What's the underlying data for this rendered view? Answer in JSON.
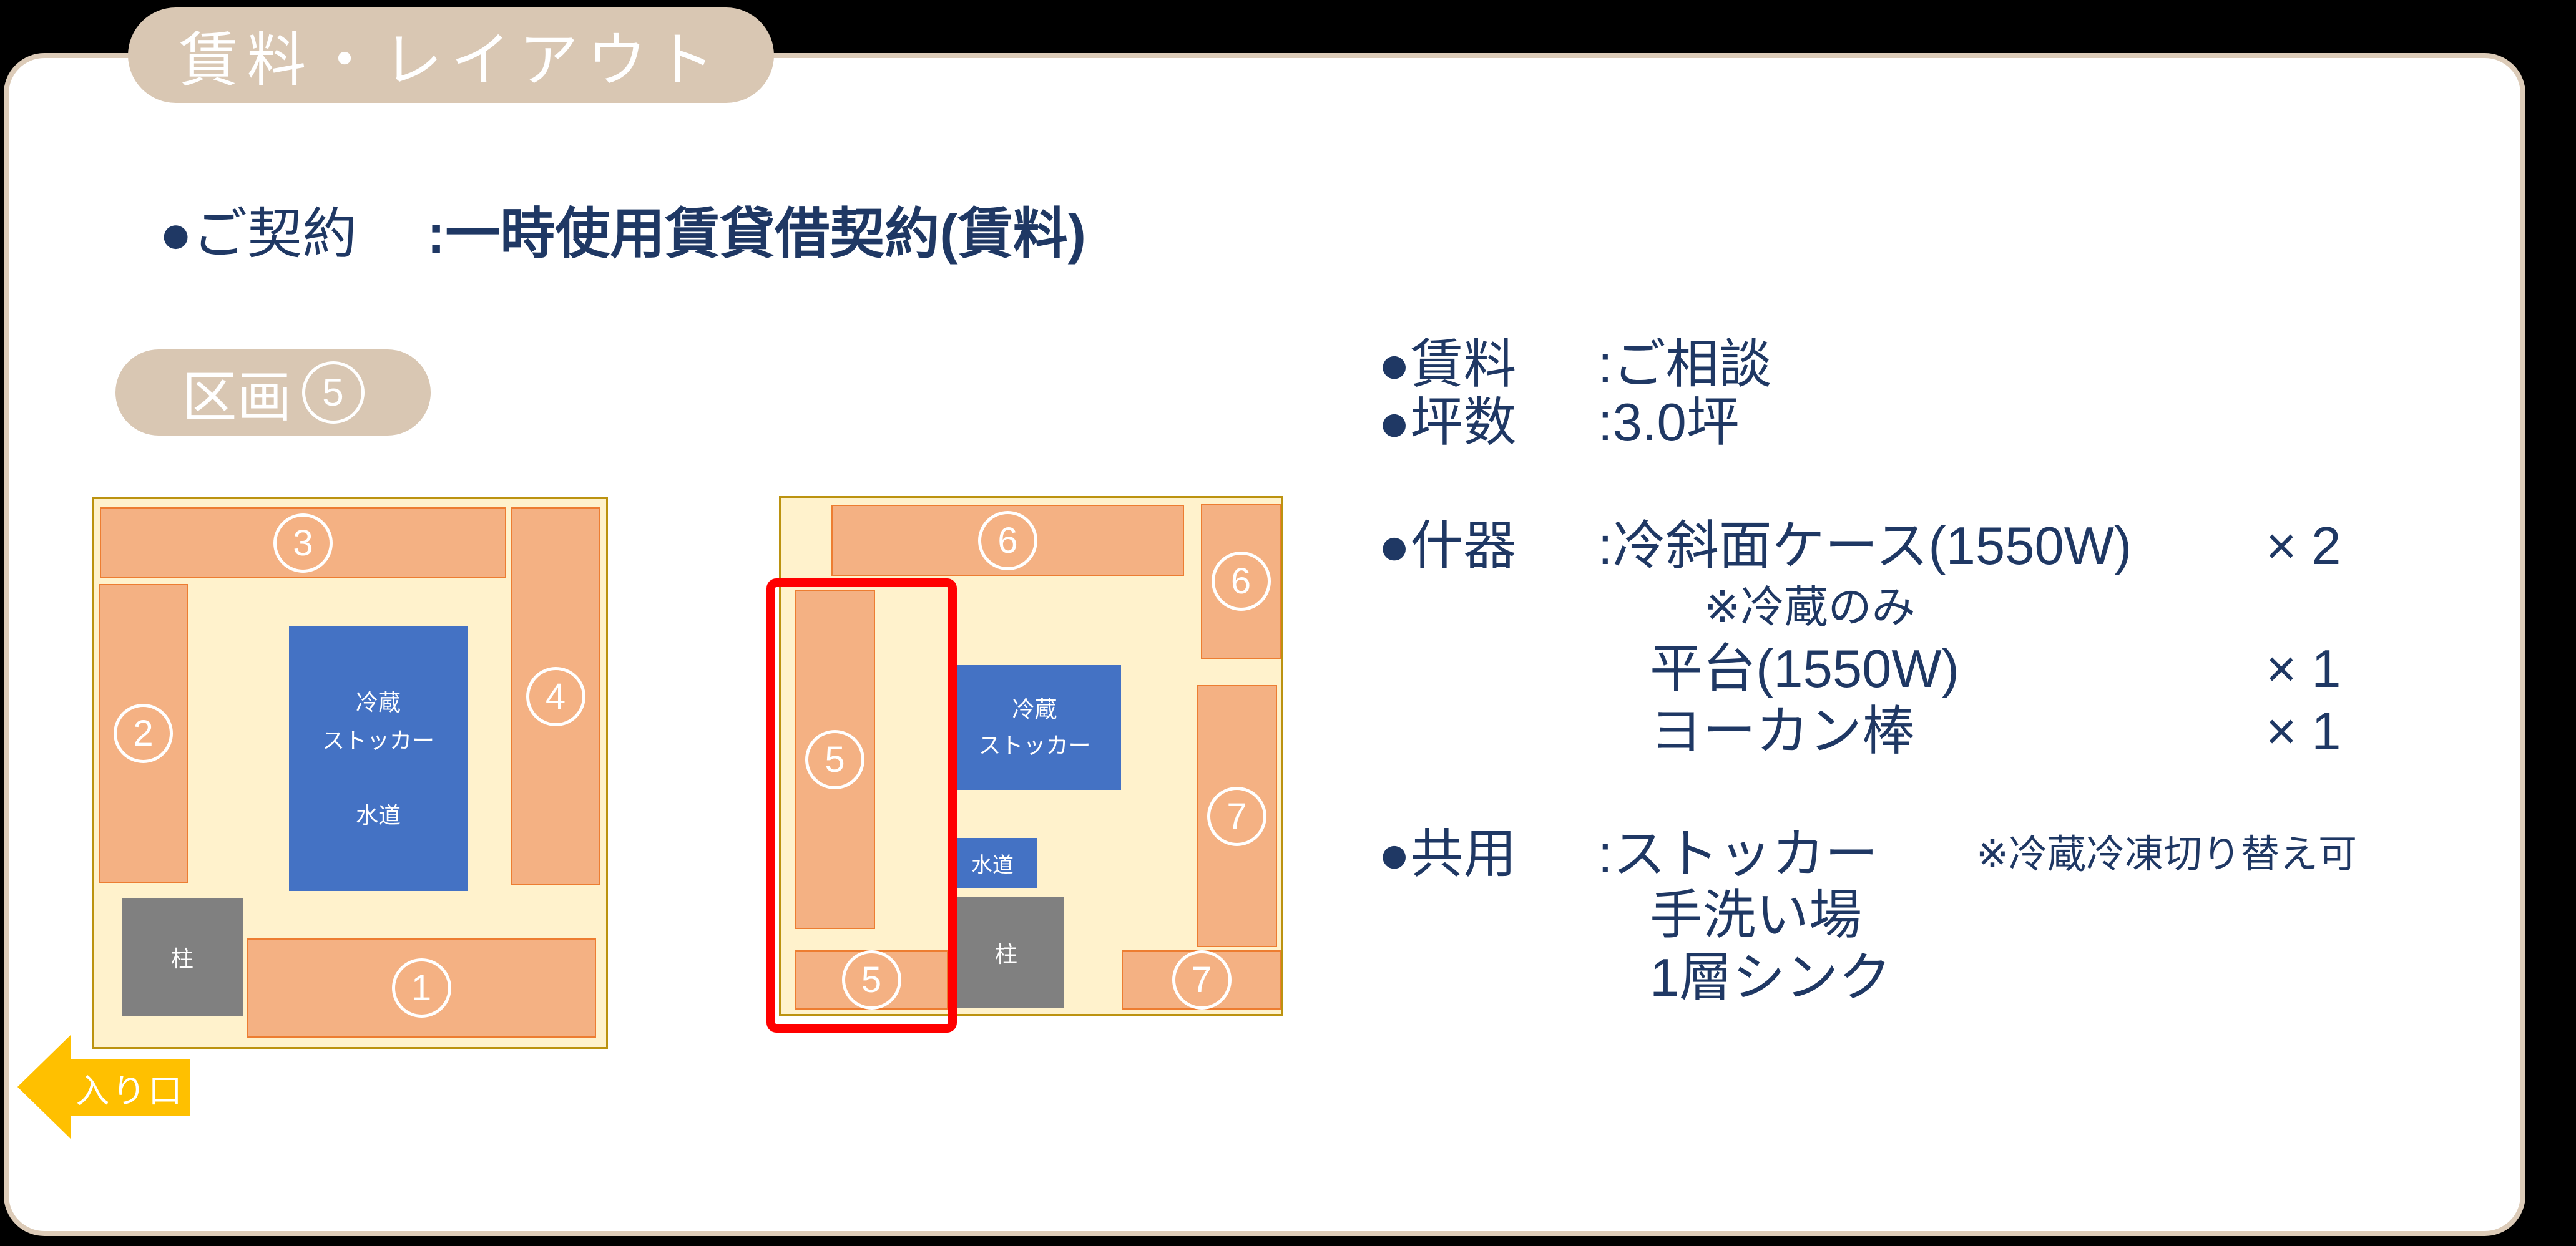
{
  "header": {
    "title": "賃料・レイアウト"
  },
  "contract": {
    "label": "●ご契約",
    "value": ":一時使用賃貸借契約(賃料)"
  },
  "section": {
    "prefix": "区画",
    "number": "5"
  },
  "plans": {
    "left": {
      "stall_top": "3",
      "stall_left": "2",
      "stall_right": "4",
      "stall_bottom": "1",
      "stocker_line1": "冷蔵",
      "stocker_line2": "ストッカー",
      "stocker_line3": "水道",
      "pillar": "柱"
    },
    "right": {
      "stall_top": "6",
      "stall_top_right": "6",
      "stall_left": "5",
      "stall_bottom_left": "5",
      "stall_right": "7",
      "stall_bottom_right": "7",
      "stocker_line1": "冷蔵",
      "stocker_line2": "ストッカー",
      "water": "水道",
      "pillar": "柱"
    }
  },
  "details": {
    "rent": {
      "label": "●賃料",
      "value": ":ご相談"
    },
    "area": {
      "label": "●坪数",
      "value": ":3.0坪"
    },
    "fixtures": {
      "label": "●什器",
      "value": ":冷斜面ケース(1550W)",
      "qty": "× 2",
      "note": "※冷蔵のみ",
      "item2": "平台(1550W)",
      "qty2": "× 1",
      "item3": "ヨーカン棒",
      "qty3": "× 1"
    },
    "shared": {
      "label": "●共用",
      "value": ":ストッカー",
      "note": "※冷蔵冷凍切り替え可",
      "item2": "手洗い場",
      "item3": "1層シンク"
    }
  },
  "entrance": {
    "label": "入り口"
  },
  "colors": {
    "background": "#000000",
    "card_border": "#DCCBB8",
    "badge_tan": "#D9C7B3",
    "text_navy": "#1F3864",
    "floor_fill": "#FFF2CC",
    "floor_border": "#BC9310",
    "stall_fill": "#F4B183",
    "stall_border": "#ED7D31",
    "fixture_blue": "#4472C4",
    "pillar_gray": "#808080",
    "highlight_red": "#FF0000",
    "entrance_yellow": "#FFC000"
  }
}
